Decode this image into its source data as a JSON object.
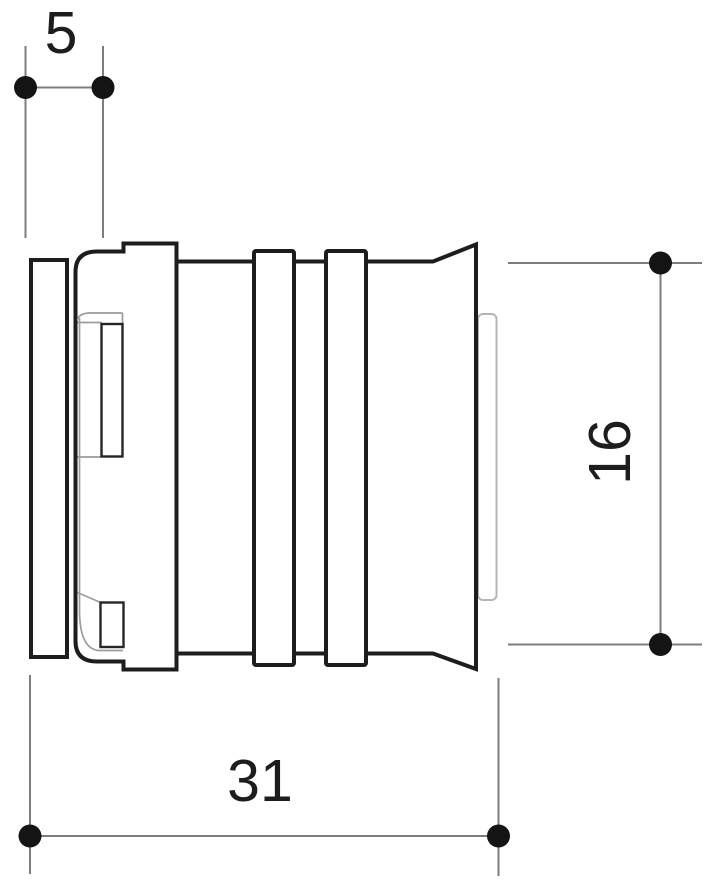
{
  "drawing": {
    "description": "Technical line drawing — press fitting (side elevation) with three dimensions",
    "dimensions": {
      "d5": {
        "label": "5"
      },
      "d16": {
        "label": "16"
      },
      "d31": {
        "label": "31"
      }
    },
    "colors": {
      "outline": "#1d1d1d",
      "inner_line": "#9c9c9c",
      "insert_line": "#b5b5b5",
      "dimension_line": "#7d7d7d",
      "marker": "#141414",
      "background": "#ffffff"
    }
  }
}
